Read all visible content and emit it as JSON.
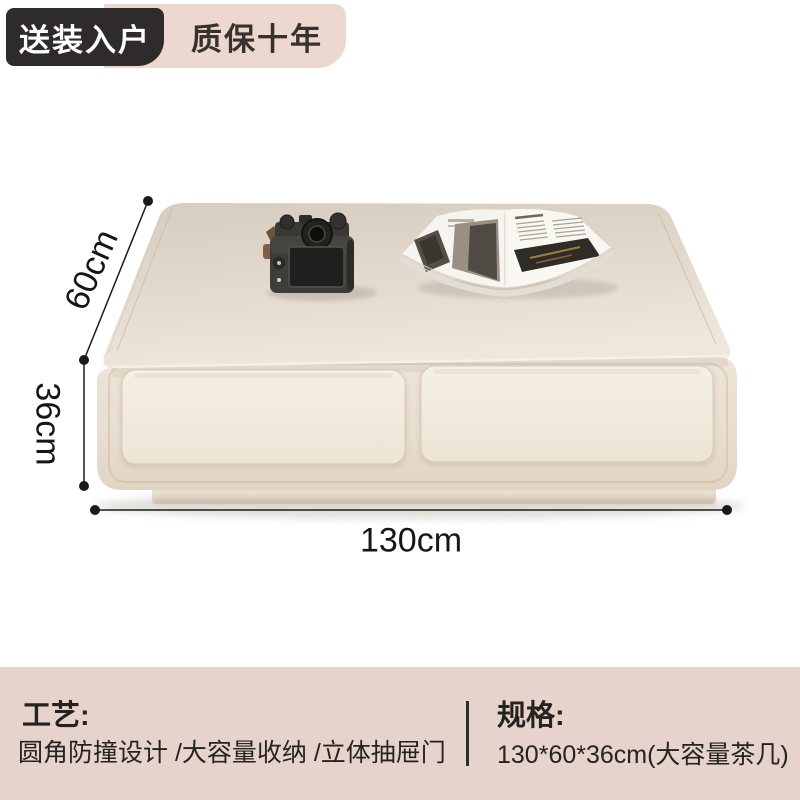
{
  "badges": {
    "delivery": "送装入户",
    "warranty": "质保十年"
  },
  "dimensions": {
    "depth": "60cm",
    "height": "36cm",
    "width": "130cm"
  },
  "info": {
    "craft_title": "工艺:",
    "craft_desc": "圆角防撞设计 /大容量收纳 /立体抽屉门",
    "spec_title": "规格:",
    "spec_desc": "130*60*36cm(大容量茶几)"
  },
  "colors": {
    "badge_dark_bg": "#2e2b2a",
    "badge_pink_bg": "#ecd8ce",
    "info_bar_bg": "#e6d3cb",
    "table_cream": "#ece3d6",
    "dimension_line": "#1b1b1b",
    "text_dark": "#262220"
  },
  "scene": {
    "product": "cream coffee table with two drawers",
    "props": [
      "camera",
      "open magazine"
    ]
  }
}
